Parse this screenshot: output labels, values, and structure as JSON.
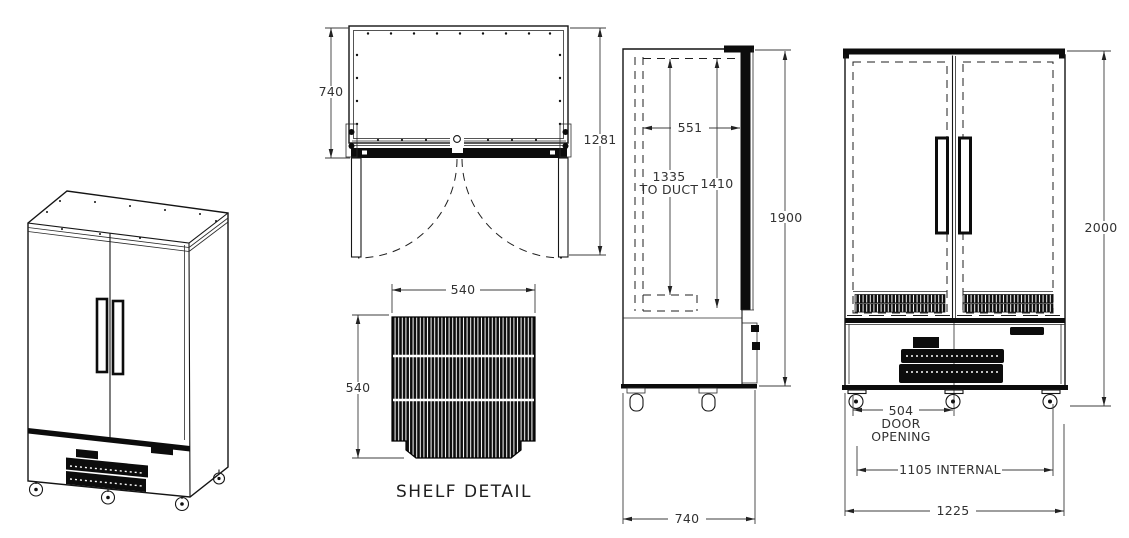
{
  "drawing": {
    "background_color": "#ffffff",
    "line_color": "#111111",
    "plan": {
      "depth": "740",
      "depth_doors_open": "1281"
    },
    "shelf": {
      "width": "540",
      "depth": "540",
      "caption": "SHELF DETAIL"
    },
    "side": {
      "internal_depth": "551",
      "duct_height": "1335",
      "duct_label": "TO DUCT",
      "internal_height": "1410",
      "cabinet_height": "1900",
      "overall_depth": "740"
    },
    "front": {
      "overall_height": "2000",
      "door_opening": "504",
      "door_opening_word1": "DOOR",
      "door_opening_word2": "OPENING",
      "internal_width": "1105 INTERNAL",
      "overall_width": "1225"
    }
  }
}
